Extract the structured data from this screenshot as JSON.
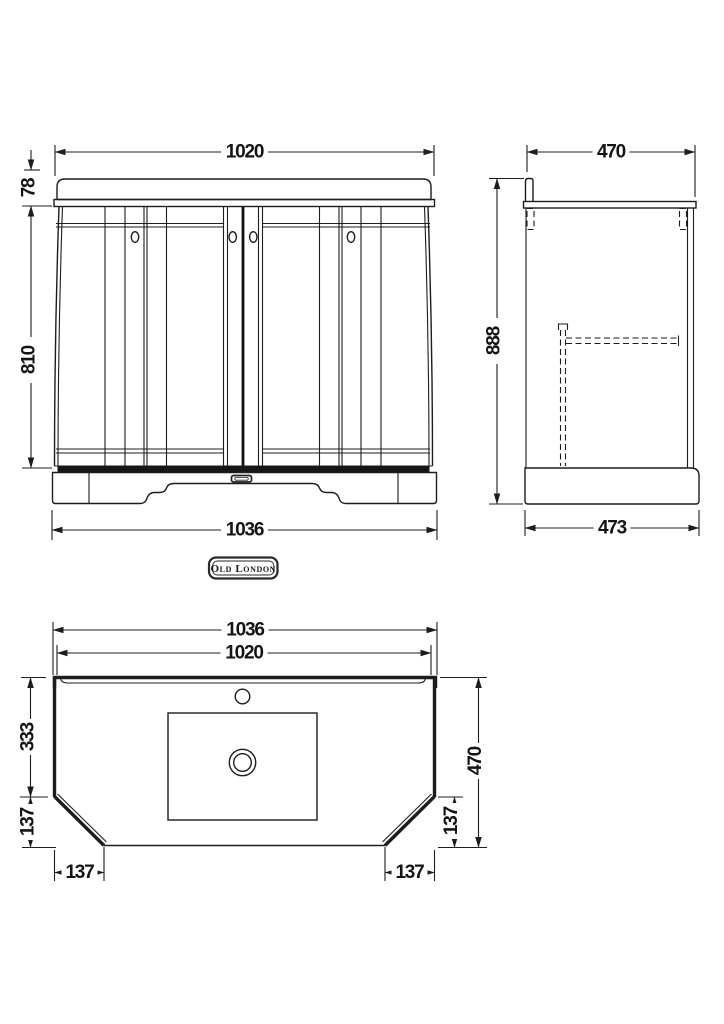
{
  "brand_badge": {
    "text": "Old London"
  },
  "views": {
    "front": {
      "top_width": "1020",
      "worktop_height": "78",
      "cabinet_height": "810",
      "base_width": "1036"
    },
    "side": {
      "top_depth": "470",
      "overall_height": "888",
      "base_depth": "473"
    },
    "plan": {
      "overall_width": "1036",
      "inner_width": "1020",
      "back_section_depth": "333",
      "chamfer_height_left": "137",
      "chamfer_width_left": "137",
      "overall_depth": "470",
      "chamfer_height_right": "137",
      "chamfer_width_right": "137"
    }
  }
}
